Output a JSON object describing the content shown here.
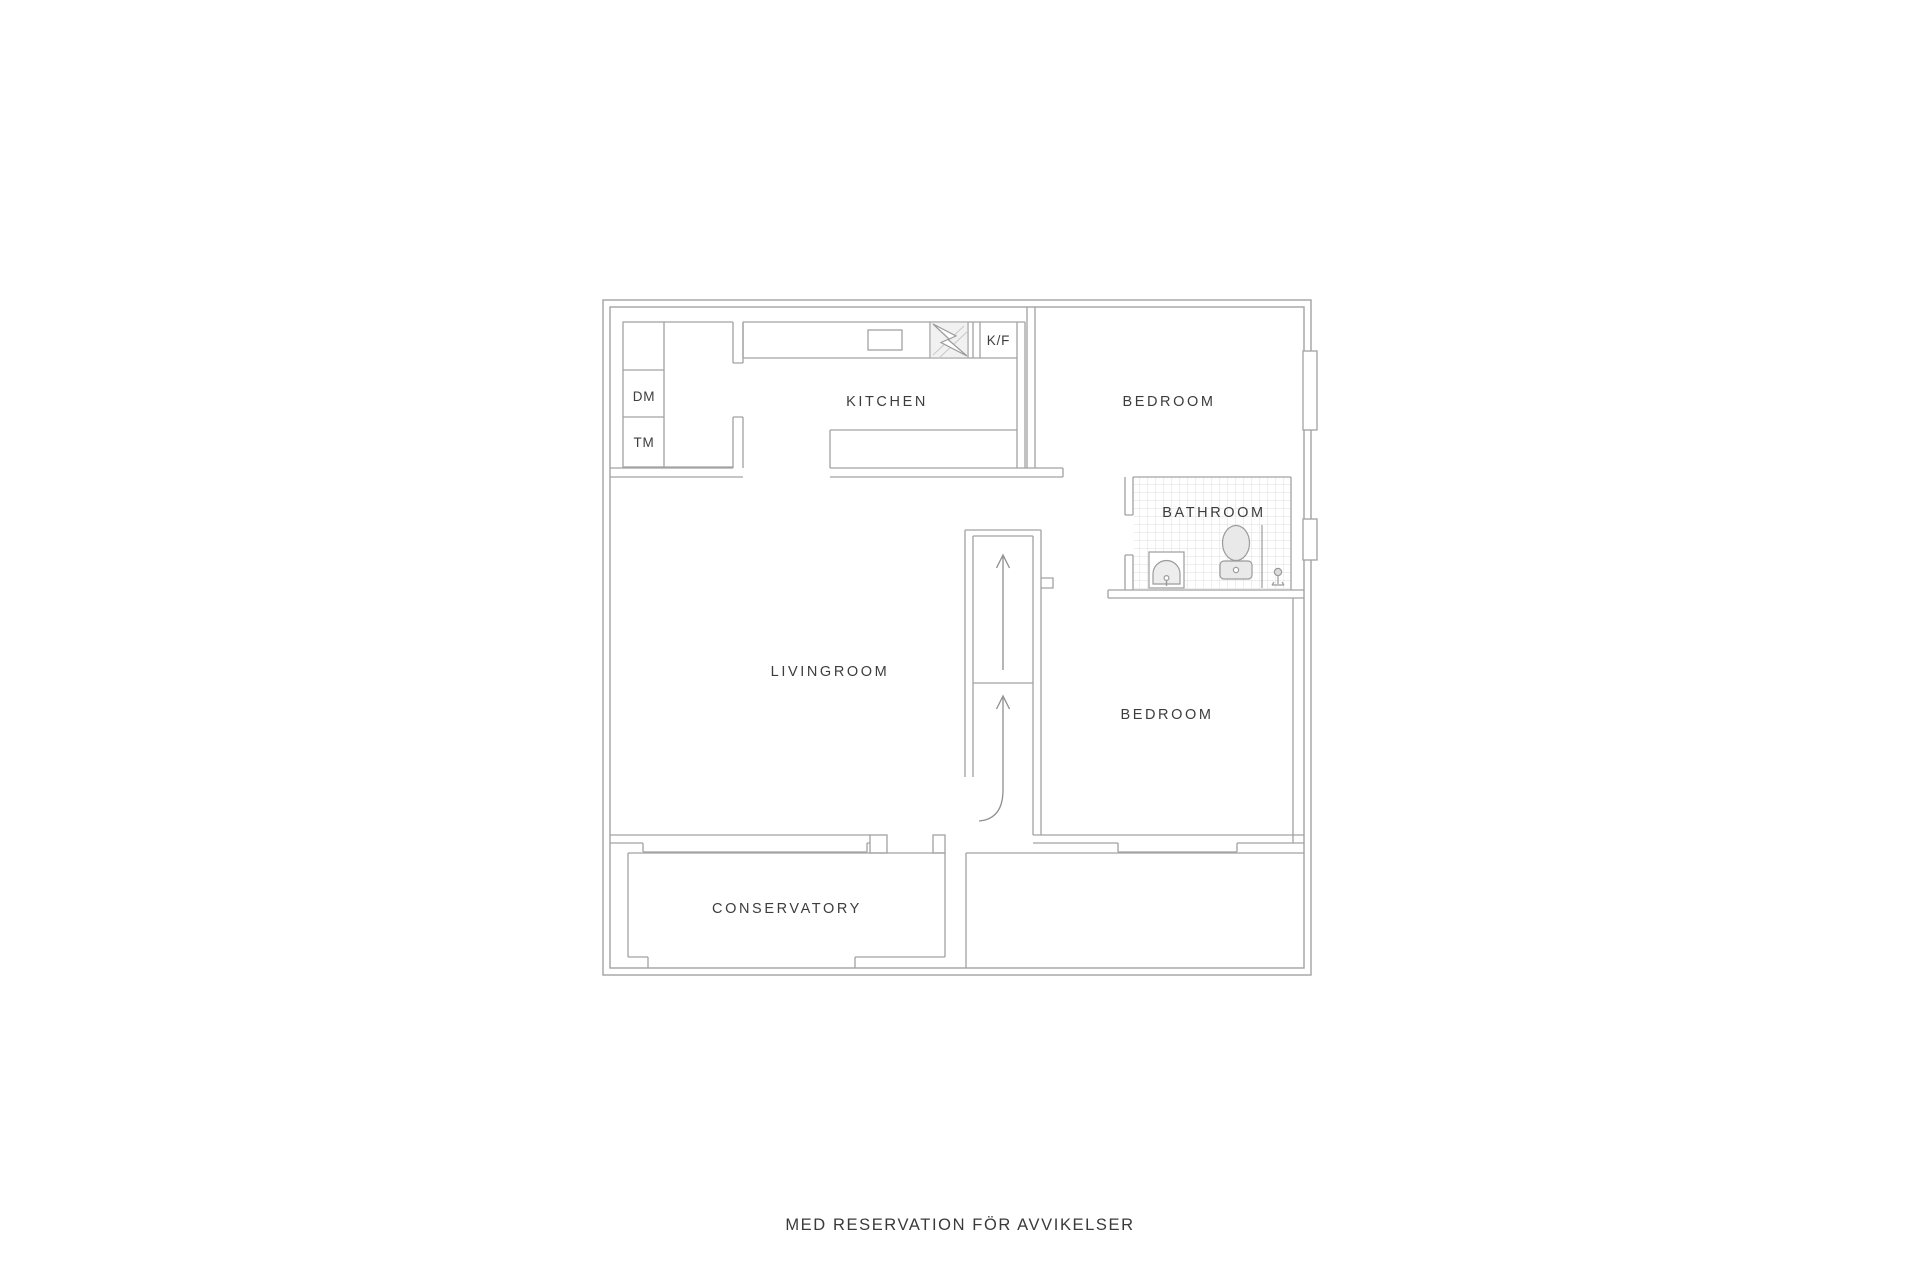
{
  "plan": {
    "rooms": {
      "kitchen": "KITCHEN",
      "bedroom_top": "BEDROOM",
      "bathroom": "BATHROOM",
      "livingroom": "LIVINGROOM",
      "bedroom_bottom": "BEDROOM",
      "conservatory": "CONSERVATORY"
    },
    "appliances": {
      "dishwasher": "DM",
      "washing_machine": "TM",
      "fridge_freezer": "K/F"
    },
    "fixtures": [
      "kitchen-sink",
      "stove-lightning",
      "bathroom-sink",
      "toilet",
      "shower-drain",
      "stairs-up-arrows",
      "windows"
    ]
  },
  "footer": {
    "disclaimer": "MED RESERVATION FÖR AVVIKELSER"
  },
  "colors": {
    "wall_line": "#a2a2a2",
    "label_text": "#3d3d3d",
    "tile_grid": "#dedede",
    "fixture_fill": "#ebebeb",
    "stove_hatch_bg": "#f1f1f1",
    "background": "#ffffff"
  }
}
